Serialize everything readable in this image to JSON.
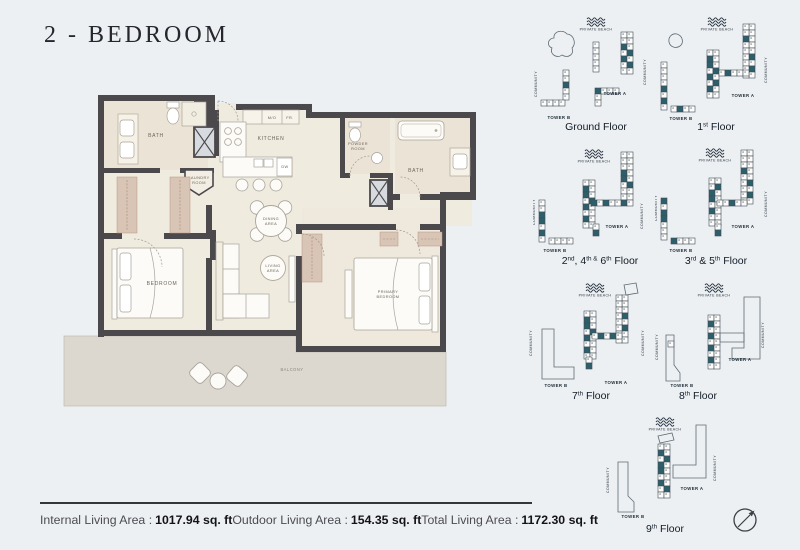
{
  "title": "2 - BEDROOM",
  "colors": {
    "background": "#edf0f3",
    "wall": "#4b494c",
    "floor": "#f0ebdf",
    "closet_pink": "#d9c5b6",
    "balcony": "#dcd8d0",
    "unit_teal": "#2d5f6b",
    "keyplan_ink": "#22313c"
  },
  "icons": {
    "compass": "north-east-arrow-compass",
    "waves": "private-beach-waves"
  },
  "floorplan": {
    "labels": {
      "bath1": "BATH",
      "kitchen": "KITCHEN",
      "mo": "M/O",
      "fr": "FR.",
      "dw": "DW",
      "laundry1": "LAUNDRY",
      "laundry2": "ROOM",
      "powder1": "POWDER",
      "powder2": "ROOM",
      "bath2": "BATH",
      "dining1": "DINING",
      "dining2": "AREA",
      "living1": "LIVING",
      "living2": "AREA",
      "bedroom": "BEDROOM",
      "primary1": "PRIMARY",
      "primary2": "BEDROOM",
      "balcony": "BALCONY"
    }
  },
  "keyplans": {
    "private_beach_label": "PRIVATE BEACH",
    "community_label": "COMMUNITY",
    "tower_a_label": "TOWER A",
    "tower_b_label": "TOWER B",
    "floors": [
      {
        "id": "ground",
        "name": "Ground Floor",
        "parts": [
          {
            "t": "Ground Floor"
          }
        ]
      },
      {
        "id": "first",
        "name": "1st Floor",
        "parts": [
          {
            "t": "1"
          },
          {
            "s": "st"
          },
          {
            "t": " Floor"
          }
        ]
      },
      {
        "id": "f2-4-6",
        "name": "2nd, 4th & 6th Floor",
        "parts": [
          {
            "t": "2"
          },
          {
            "s": "nd"
          },
          {
            "t": ", 4"
          },
          {
            "s": "th &"
          },
          {
            "t": " 6"
          },
          {
            "s": "th"
          },
          {
            "t": " Floor"
          }
        ]
      },
      {
        "id": "f3-5",
        "name": "3rd & 5th Floor",
        "parts": [
          {
            "t": "3"
          },
          {
            "s": "rd"
          },
          {
            "t": " & 5"
          },
          {
            "s": "th"
          },
          {
            "t": " Floor"
          }
        ]
      },
      {
        "id": "f7",
        "name": "7th Floor",
        "parts": [
          {
            "t": "7"
          },
          {
            "s": "th"
          },
          {
            "t": " Floor"
          }
        ]
      },
      {
        "id": "f8",
        "name": "8th Floor",
        "parts": [
          {
            "t": "8"
          },
          {
            "s": "th"
          },
          {
            "t": " Floor"
          }
        ]
      },
      {
        "id": "f9",
        "name": "9th Floor",
        "parts": [
          {
            "t": "9"
          },
          {
            "s": "th"
          },
          {
            "t": " Floor"
          }
        ]
      }
    ]
  },
  "stats": [
    {
      "label": "Internal Living Area :",
      "value": "1017.94 sq. ft"
    },
    {
      "label": "Outdoor Living Area :",
      "value": "154.35 sq. ft"
    },
    {
      "label": "Total Living Area :",
      "value": "1172.30 sq. ft"
    }
  ]
}
